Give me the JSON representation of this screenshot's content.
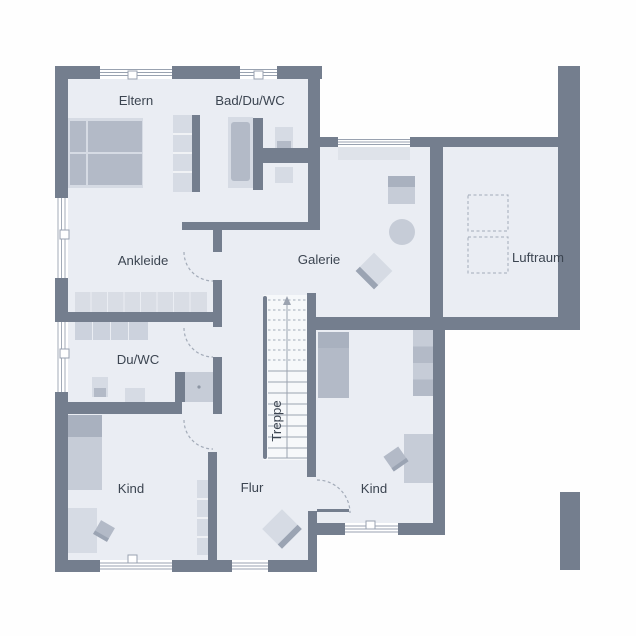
{
  "plan": {
    "type": "floor-plan",
    "level": "upper-floor",
    "labels": {
      "eltern": "Eltern",
      "bad": "Bad/Du/WC",
      "ankleide": "Ankleide",
      "galerie": "Galerie",
      "luftraum": "Luftraum",
      "duwc": "Du/WC",
      "kind_left": "Kind",
      "flur": "Flur",
      "kind_right": "Kind",
      "treppe": "Treppe"
    },
    "stairs": {
      "label": "Treppe",
      "direction": "up",
      "treads_dashed": 7,
      "treads_solid": 9
    },
    "furniture": {
      "eltern": [
        "double-bed",
        "wardrobe"
      ],
      "bad": [
        "bathtub",
        "sink",
        "wc"
      ],
      "ankleide": [
        "closet-row-8",
        "closet-row-4"
      ],
      "duwc": [
        "sink",
        "wc",
        "shower"
      ],
      "galerie": [
        "desk-with-chair",
        "round-table",
        "armchair"
      ],
      "luftraum": [
        "dashed-opening",
        "dashed-opening"
      ],
      "kind_left": [
        "bed",
        "desk",
        "chair",
        "wardrobe"
      ],
      "kind_right": [
        "bed",
        "wardrobe",
        "desk",
        "chair"
      ],
      "flur": [
        "armchair"
      ]
    },
    "counts": {
      "windows": 8,
      "door_arcs": 4
    }
  },
  "colors": {
    "bg": "#fefefe",
    "floor": "#eaedf3",
    "stair_bg": "#f6f8fa",
    "wall": "#747e8e",
    "window_fill": "#ffffff",
    "window_line": "#99a2b0",
    "sill": "#dfe3ea",
    "f_light": "#d6dbe4",
    "f_mid": "#c6ccd7",
    "f_dark": "#b3bac7",
    "f_deep": "#a9b1bf",
    "band": "#9ba4b3",
    "cell": "#d9dde5",
    "cell2": "#ccd2dd",
    "dash": "#a3abb8",
    "tread": "#9ba3b0",
    "text": "#3c4551"
  }
}
